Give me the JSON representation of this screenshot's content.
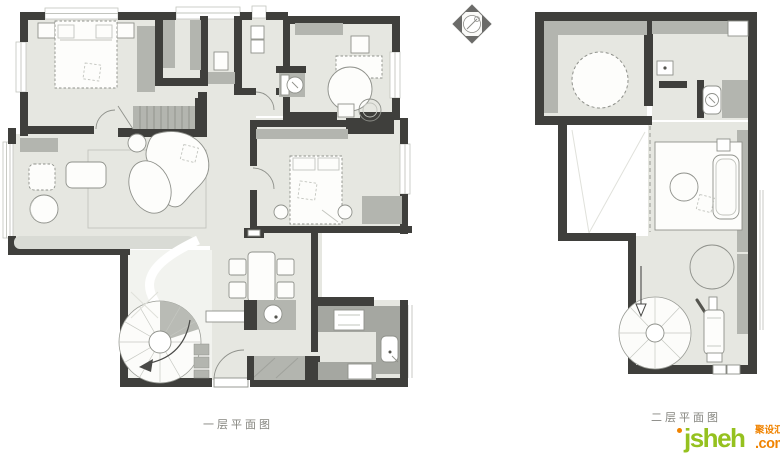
{
  "page": {
    "background": "#ffffff"
  },
  "captions": {
    "floor1": "一层平面图",
    "floor2": "二层平面图"
  },
  "watermark": {
    "name": "jsheh",
    "cn": "聚设汇",
    "tld": ".com"
  },
  "icons": {
    "compass": "north-compass-diamond-icon"
  },
  "colors": {
    "page_bg": "#ffffff",
    "wall": "#3f3f3c",
    "floor": "#e6e7e1",
    "floor_light": "#f2f3ef",
    "furn": "#b3b5af",
    "furn_dark": "#a5a7a1",
    "bench": "#d9dbd5",
    "line": "#8f918b",
    "line_light": "#c2c4be",
    "line_faint": "#e0e1db",
    "compass_dark": "#6b6b69",
    "caption": "#85857f",
    "logo_green": "#95c11f",
    "logo_orange": "#f08300"
  }
}
